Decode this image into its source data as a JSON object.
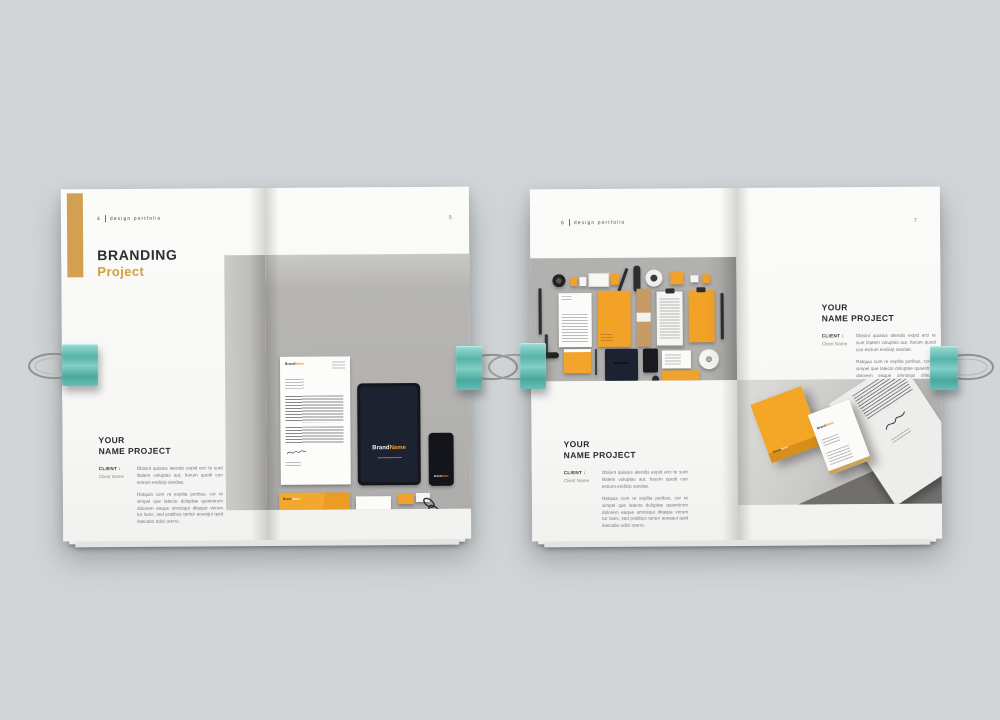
{
  "brand": {
    "part1": "Brand",
    "part2": "Name",
    "full": "BrandName"
  },
  "header": {
    "label": "design portfolio"
  },
  "left_spread": {
    "left_page": {
      "number": "4",
      "title_line1": "BRANDING",
      "title_line2": "Project"
    },
    "right_page": {
      "number": "5"
    }
  },
  "right_spread": {
    "left_page": {
      "number": "6"
    },
    "right_page": {
      "number": "7"
    }
  },
  "project_block": {
    "heading_line1": "YOUR",
    "heading_line2": "NAME PROJECT",
    "client_label": "CLIENT :",
    "client_name": "Client Name",
    "paragraph1": "Obisint quiatus atendis expid erci te sunt litatem voluptas aut, harum quodi con estrum endicip sandae.",
    "paragraph2": "Ratquia cum re explita poribus, cor re simpel que latecto doluptae quaestrum dolorem eaque omnisqui ditaque verum tur lanis, sed pratibus tantur aceaqui quid itaecabo odici orerro."
  },
  "colors": {
    "background": "#d1d5d7",
    "accent_orange": "#f0a22c",
    "accent_gold": "#d2a050",
    "clip_teal": "#74c7bf",
    "device_navy": "#1d2230"
  }
}
